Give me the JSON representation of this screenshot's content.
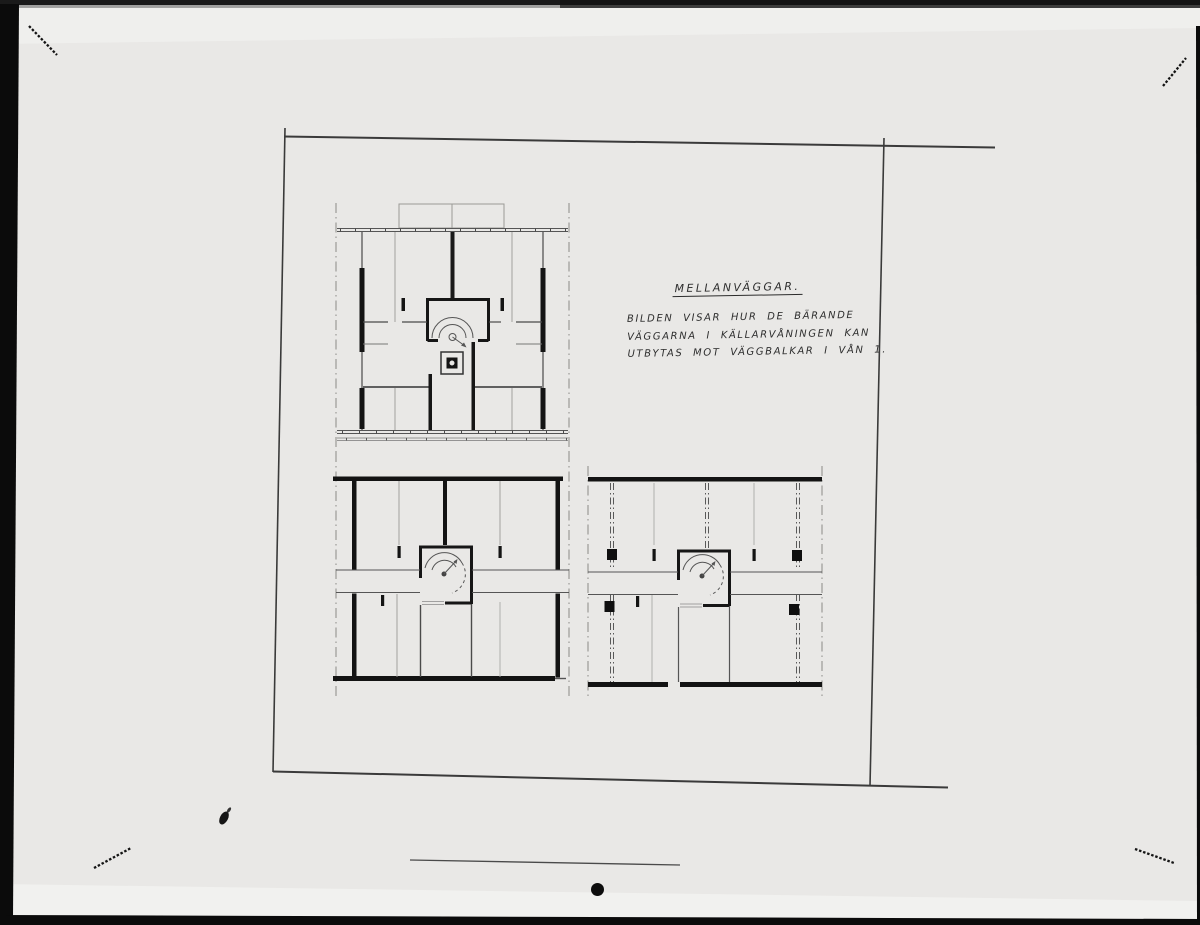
{
  "annotation": {
    "title": "MELLANVÄGGAR.",
    "line1": "BILDEN VISAR HUR DE BÄRANDE",
    "line2": "VÄGGARNA I KÄLLARVÅNINGEN KAN",
    "line3": "UTBYTAS MOT VÄGGBALKAR I VÅN 1."
  },
  "colors": {
    "paper": "#e9e8e6",
    "paper_light": "#f3f3f1",
    "film_black": "#0b0b0b",
    "ink_heavy": "#141414",
    "ink_medium": "#444444",
    "ink_light": "#9a9a96"
  }
}
